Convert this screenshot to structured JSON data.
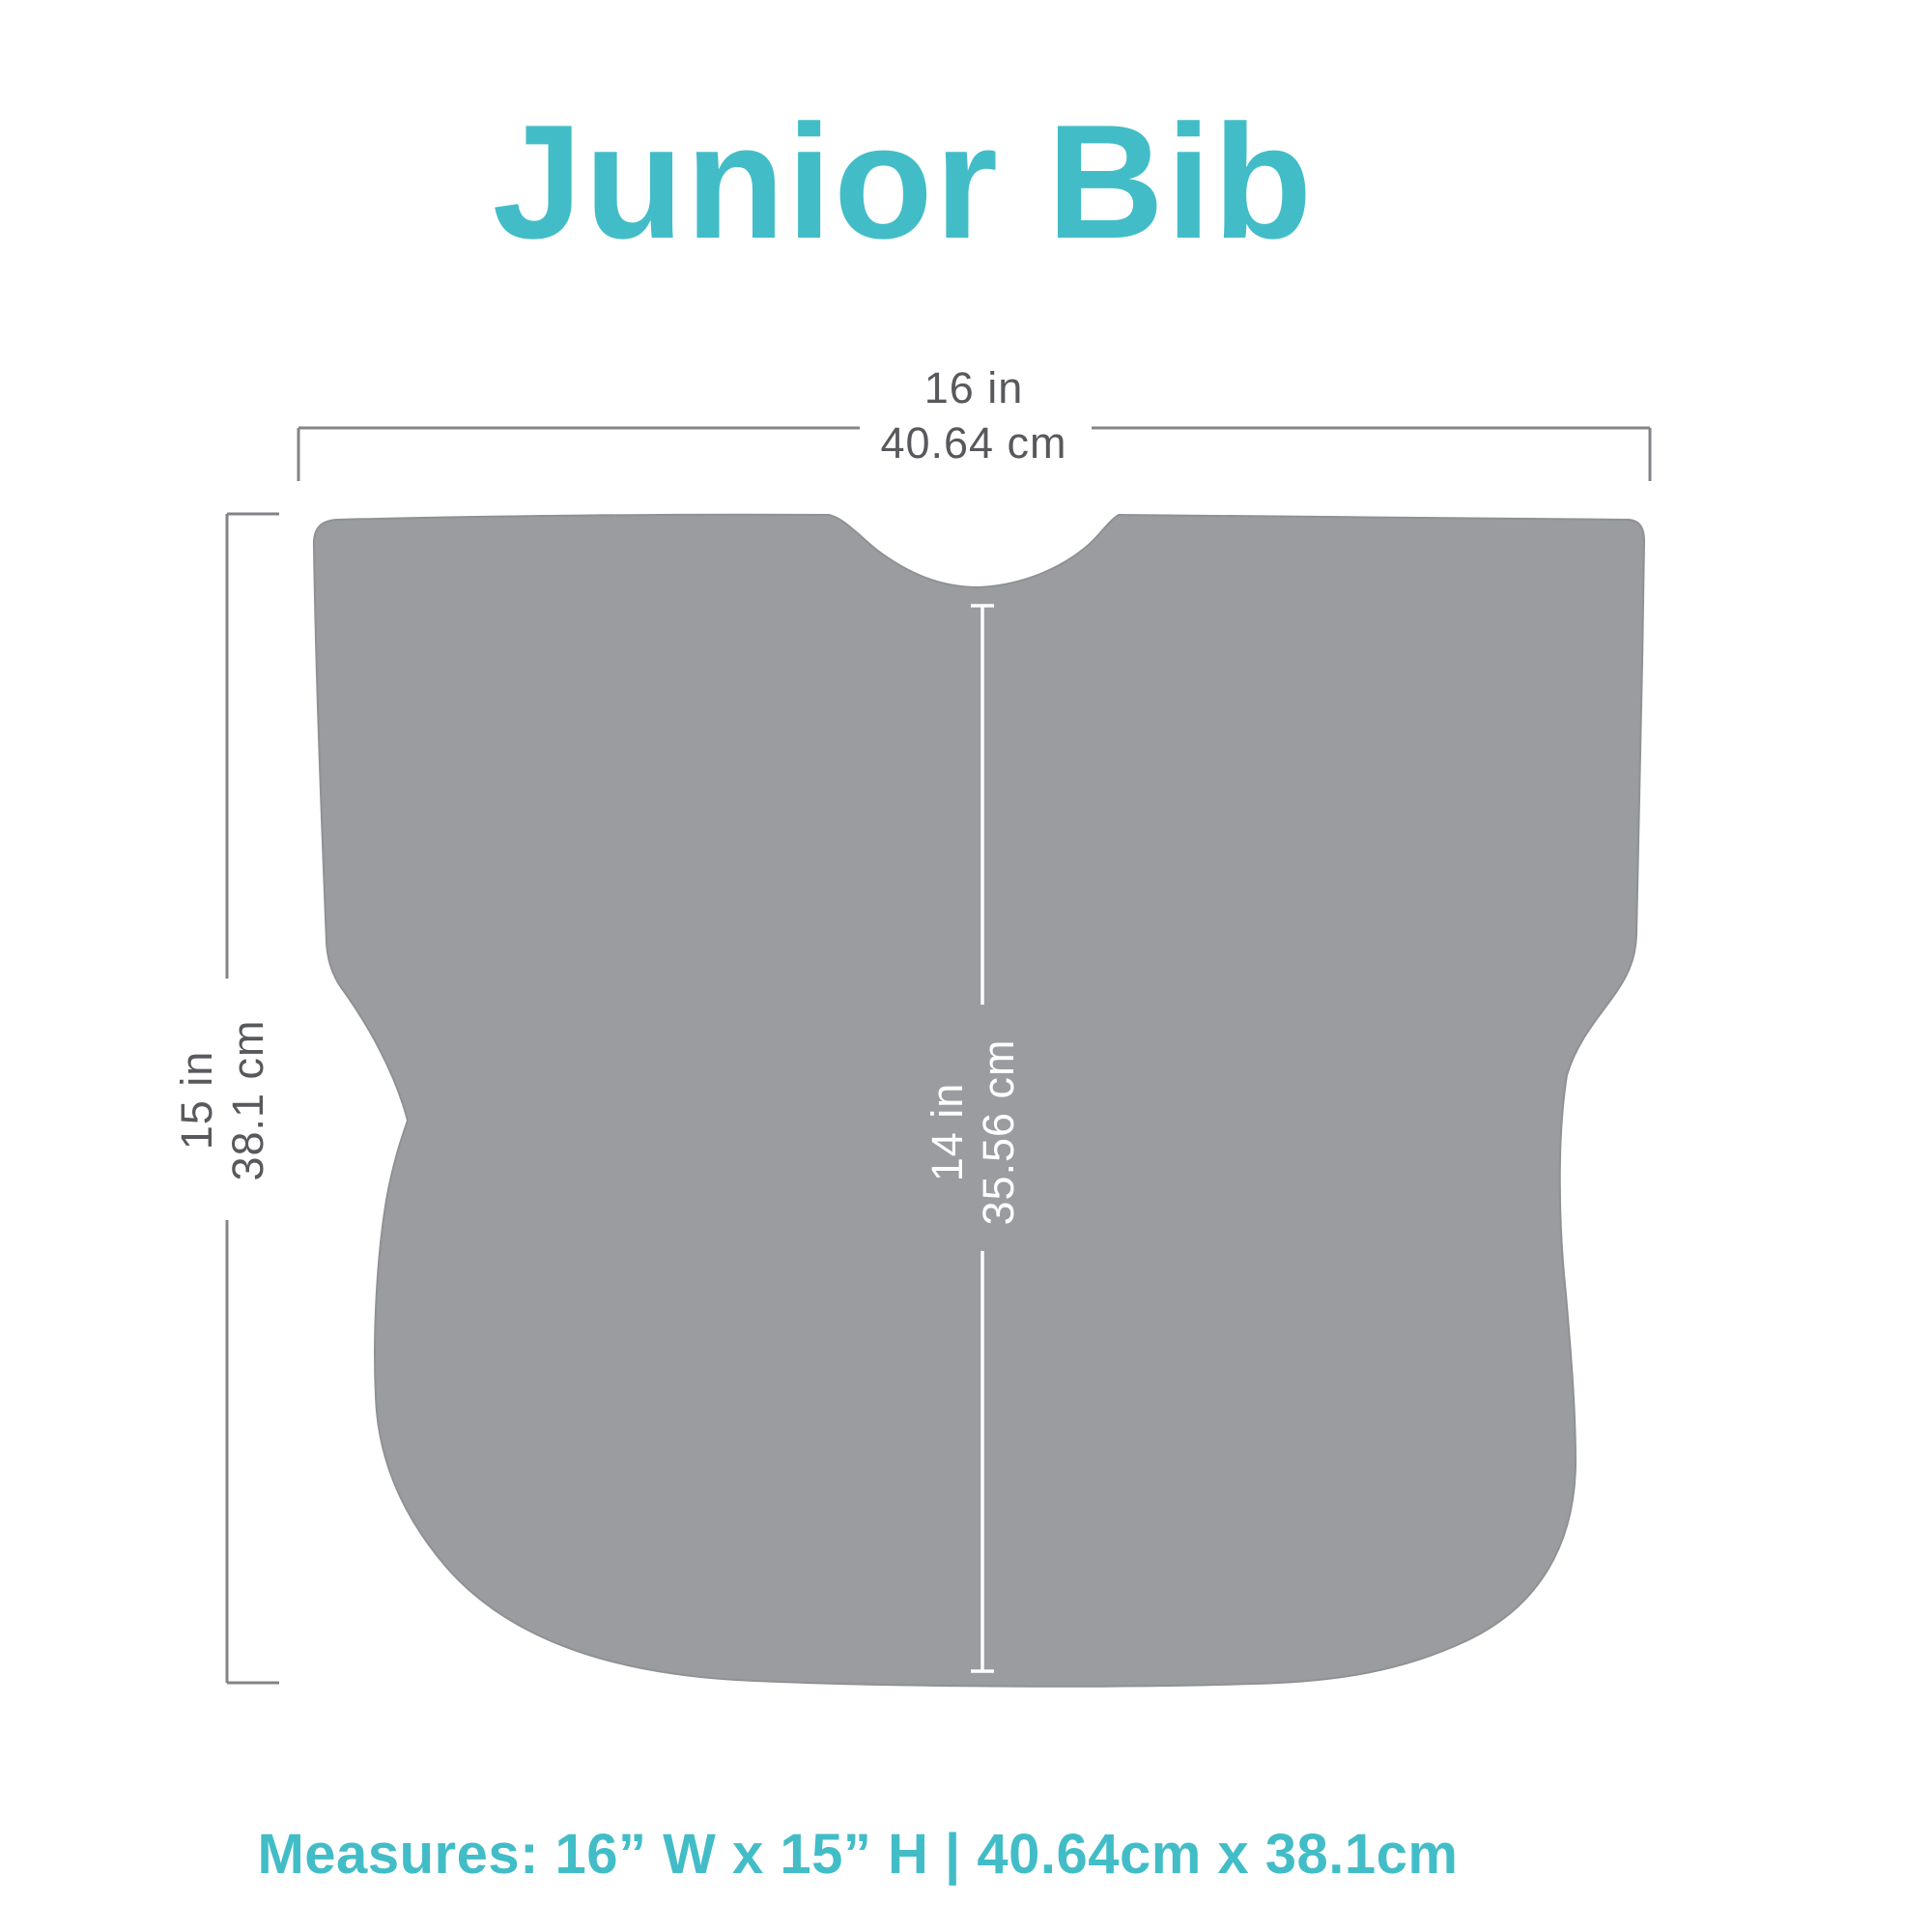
{
  "title": {
    "text": "Junior Bib"
  },
  "diagram": {
    "width_dim": {
      "line1": "16 in",
      "line2": "40.64 cm"
    },
    "height_dim": {
      "line1": "15 in",
      "line2": "38.1 cm"
    },
    "inner_dim": {
      "line1": "14 in",
      "line2": "35.56 cm"
    }
  },
  "footer": {
    "text": "Measures: 16” W x 15” H  |  40.64cm x 38.1cm"
  },
  "colors": {
    "bg": "#ffffff",
    "teal": "#42bdc7",
    "bib": "#9a9c9f",
    "bib-edge": "#8f9194",
    "line": "#828488",
    "label": "#58595c",
    "inner-label": "#ffffff"
  }
}
